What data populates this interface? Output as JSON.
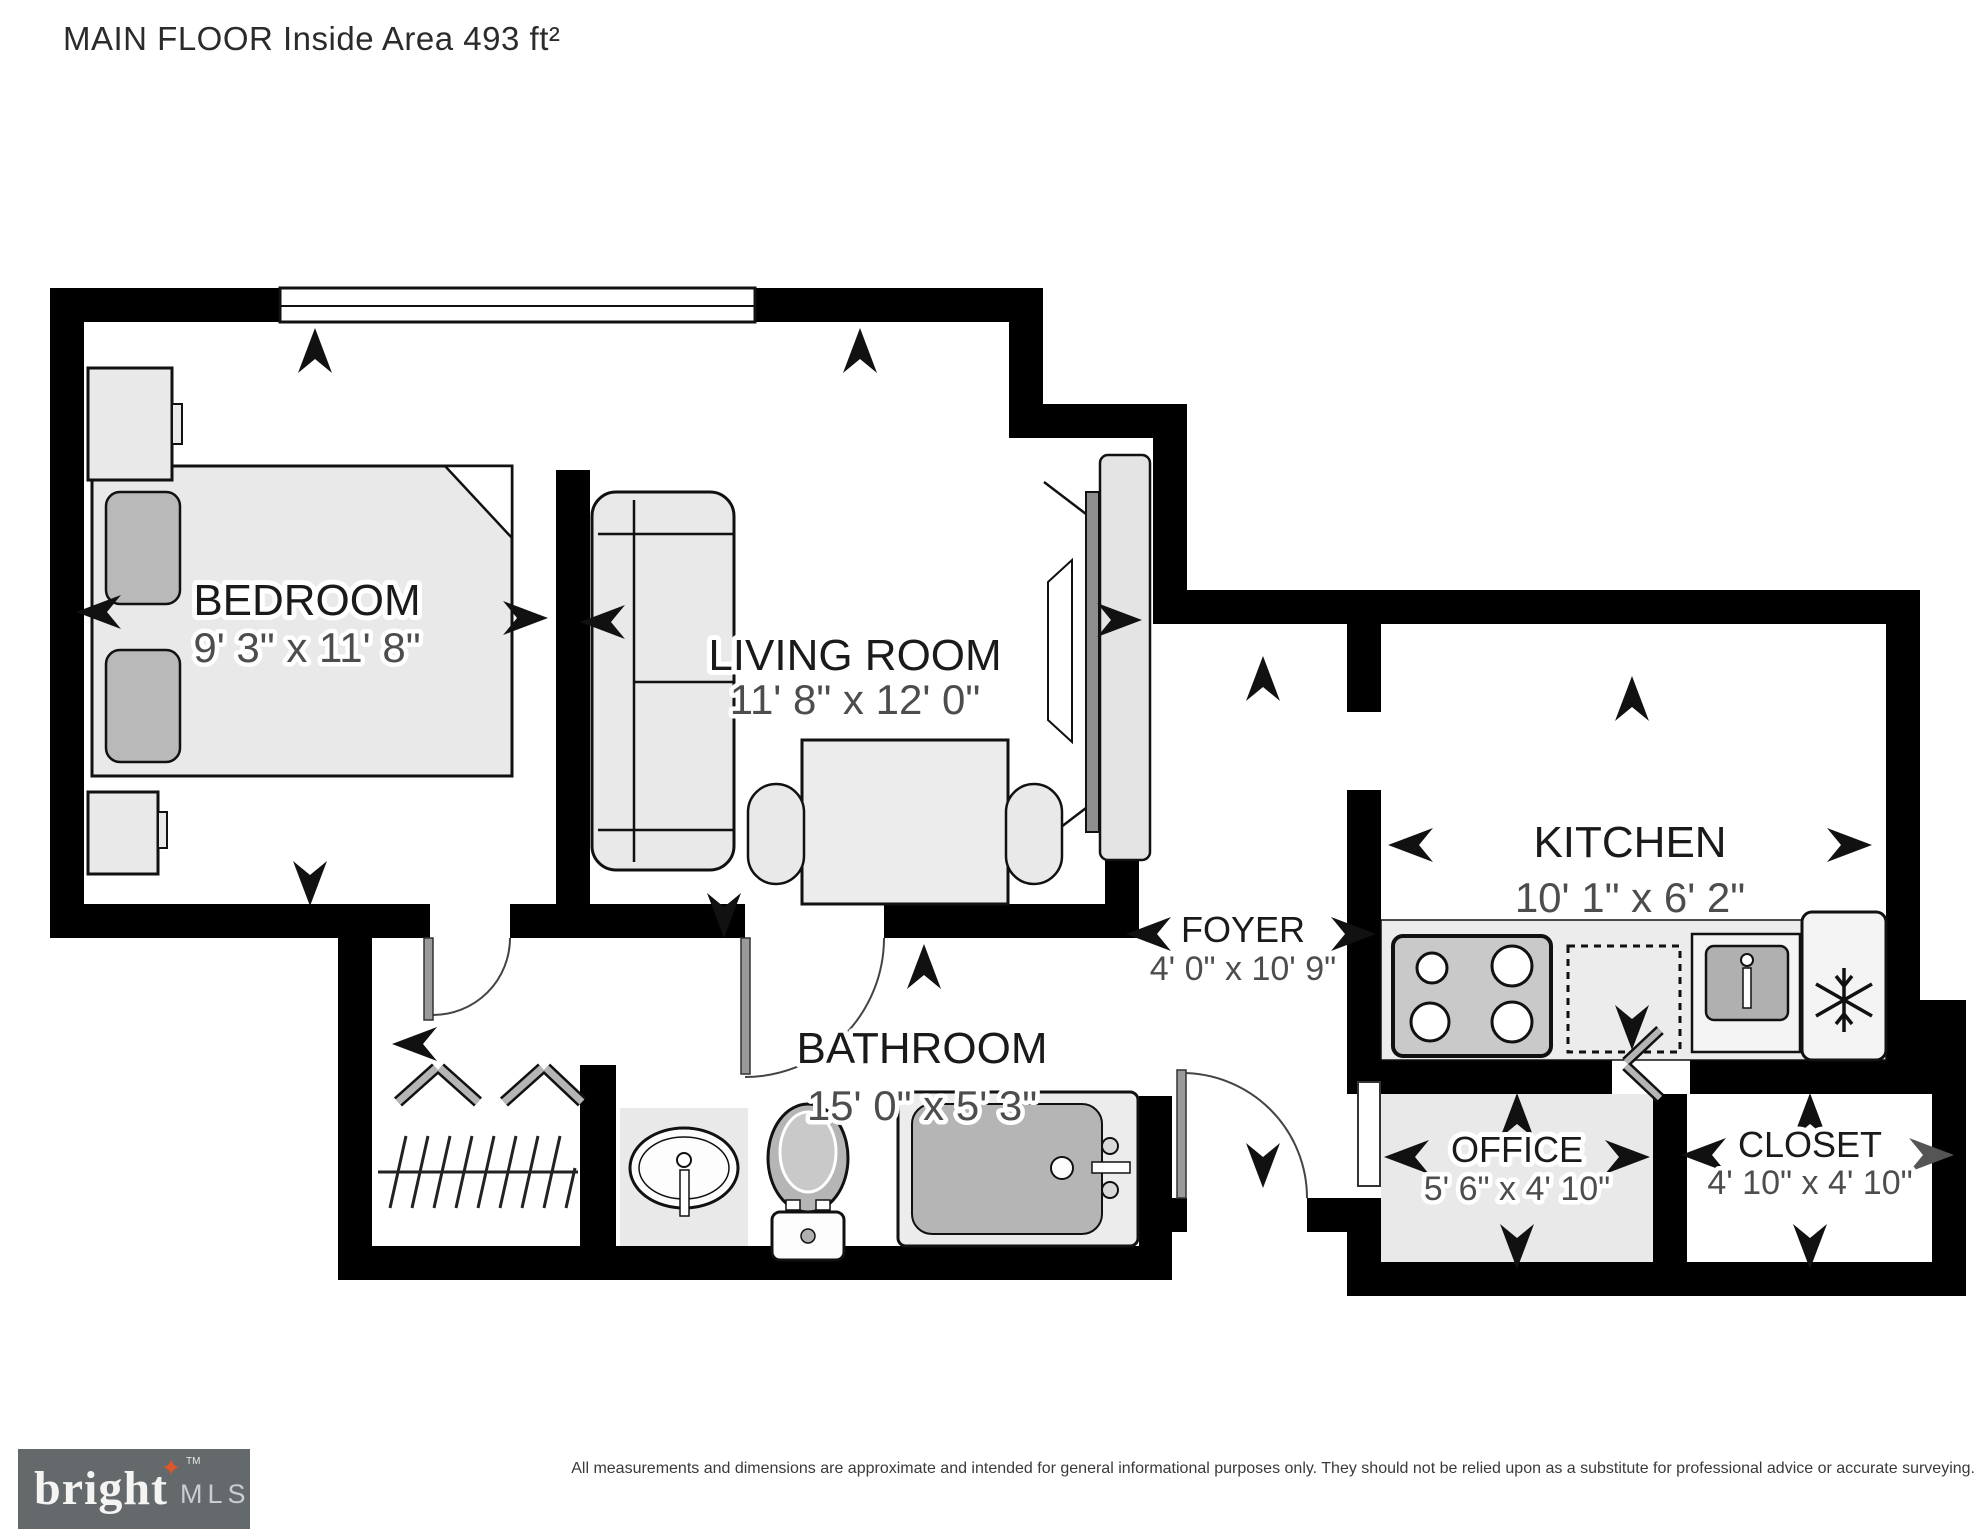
{
  "title": "MAIN FLOOR Inside Area 493 ft²",
  "rooms": [
    {
      "name": "BEDROOM",
      "dims": "9' 3\" x 11' 8\""
    },
    {
      "name": "LIVING ROOM",
      "dims": "11' 8\" x 12' 0\""
    },
    {
      "name": "KITCHEN",
      "dims": "10' 1\" x 6' 2\""
    },
    {
      "name": "FOYER",
      "dims": "4' 0\" x 10' 9\""
    },
    {
      "name": "BATHROOM",
      "dims": "15' 0\" x 5' 3\""
    },
    {
      "name": "OFFICE",
      "dims": "5' 6\" x 4' 10\""
    },
    {
      "name": "CLOSET",
      "dims": "4' 10\" x 4' 10\""
    }
  ],
  "branding": {
    "logo_text": "bright",
    "tm": "TM",
    "logo_suffix": "MLS",
    "star_glyph": "✦",
    "logo_bg": "#64696c",
    "logo_star_color": "#e0562a"
  },
  "disclaimer": "All measurements and dimensions are approximate and intended for general informational purposes only. They should not be relied upon as a substitute for professional advice or accurate surveying.",
  "colors": {
    "walls": "#000000",
    "floor": "#ffffff",
    "furniture_fill": "#e9e9e9",
    "appliance_gray": "#c9c9c9",
    "fixture_gray": "#b5b5b5",
    "counter": "#ececec",
    "office_floor": "#e9e9e9",
    "label_text": "#1a1a1a",
    "dim_text": "#4d4d4d"
  },
  "icons": [
    "bed",
    "pillow",
    "nightstand",
    "sofa",
    "tv-console",
    "dining-table",
    "chair",
    "stove",
    "dishwasher",
    "kitchen-sink",
    "refrigerator-snowflake",
    "bathroom-sink",
    "toilet",
    "bathtub",
    "closet-rail",
    "bifold-door",
    "door-swing",
    "window",
    "direction-arrow"
  ]
}
